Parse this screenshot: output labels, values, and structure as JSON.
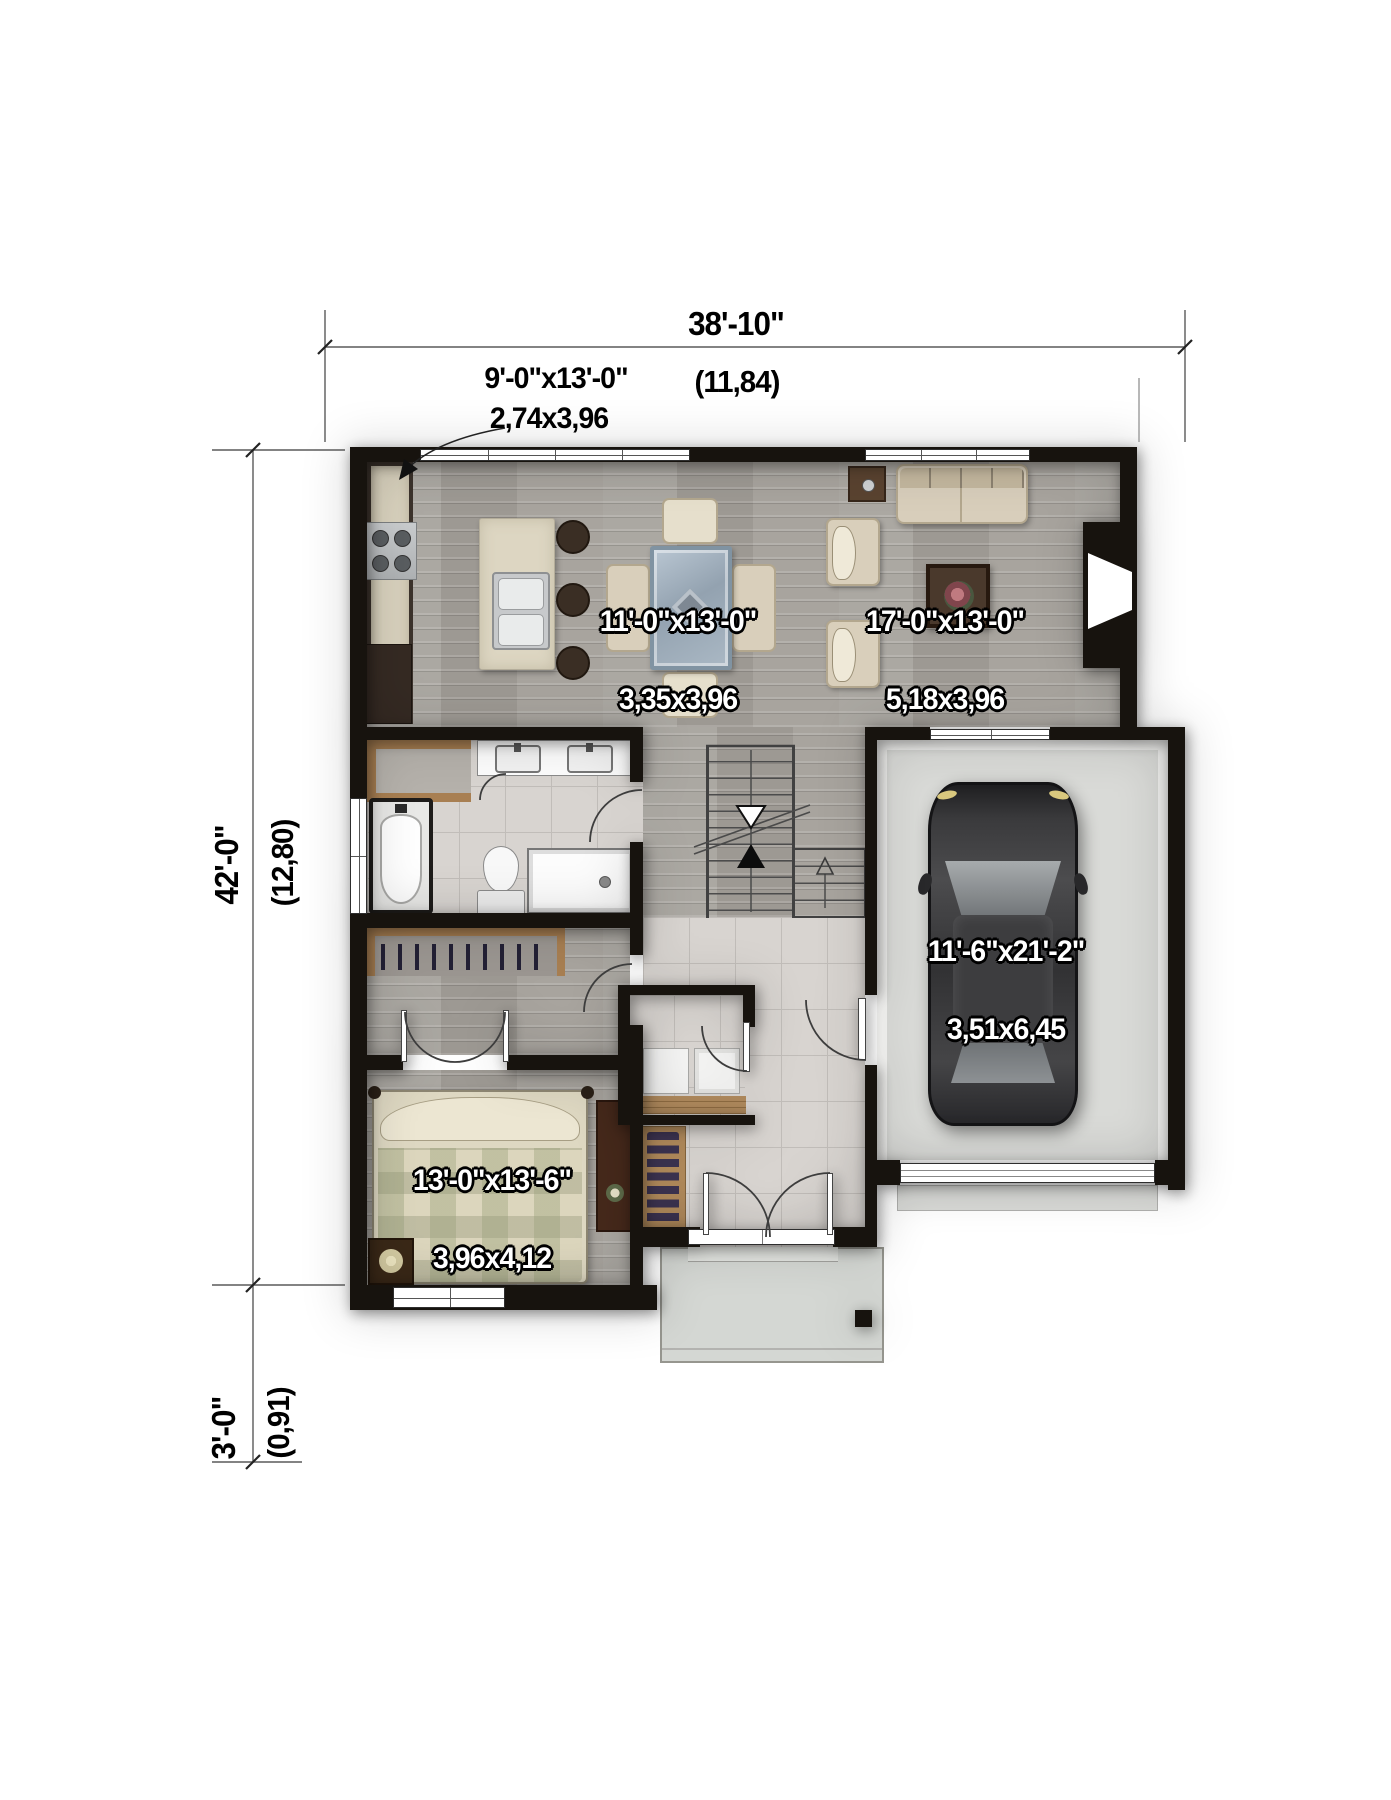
{
  "annotations": {
    "width": {
      "feet": "38'-10\"",
      "meters": "(11,84)"
    },
    "depth": {
      "feet": "42'-0\"",
      "meters": "(12,80)"
    },
    "porch": {
      "feet": "3'-0\"",
      "meters": "(0,91)"
    }
  },
  "rooms": {
    "kitchen": {
      "feet": "9'-0\"x13'-0\"",
      "meters": "2,74x3,96"
    },
    "dining": {
      "feet": "11'-0\"x13'-0\"",
      "meters": "3,35x3,96"
    },
    "living": {
      "feet": "17'-0\"x13'-0\"",
      "meters": "5,18x3,96"
    },
    "garage": {
      "feet": "11'-6\"x21'-2\"",
      "meters": "3,51x6,45"
    },
    "bedroom": {
      "feet": "13'-0\"x13'-6\"",
      "meters": "3,96x4,12"
    }
  },
  "colors": {
    "wall": "#17130e",
    "wood_floor": "#a5a19b",
    "tile_floor": "#d8d4d0",
    "concrete": "#d9dad7",
    "counter": "#d8d1bd",
    "cabinet_wood": "#3c332c",
    "closet_wood": "#a87f52",
    "upholstery": "#d9cfbb",
    "car_body": "#3a3a3c",
    "label_text": "#ffffff",
    "dimension_text": "#000000"
  }
}
